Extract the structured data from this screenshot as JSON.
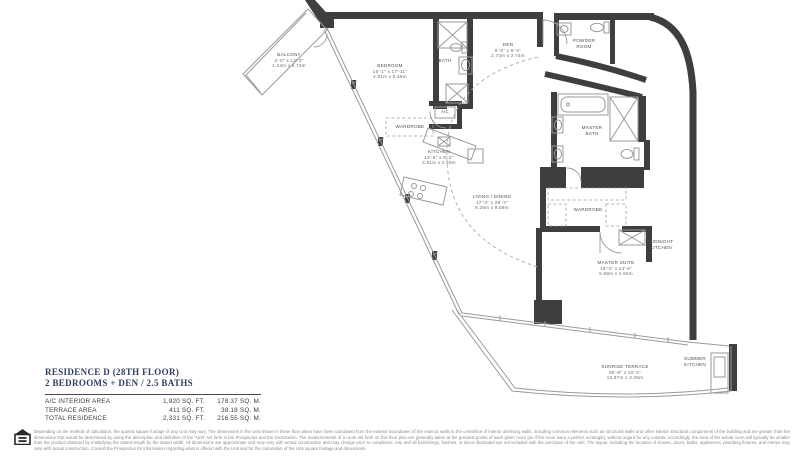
{
  "title_block": {
    "line1": "RESIDENCE D (28TH FLOOR)",
    "line2": "2 BEDROOMS + DEN / 2.5 BATHS"
  },
  "area_table": {
    "rows": [
      {
        "label": "A/C INTERIOR AREA",
        "sqft": "1,920 SQ. FT.",
        "sqm": "178.37 SQ. M."
      },
      {
        "label": "TERRACE AREA",
        "sqft": "411 SQ. FT.",
        "sqm": "38.18 SQ. M."
      },
      {
        "label": "TOTAL RESIDENCE",
        "sqft": "2,331 SQ. FT.",
        "sqm": "216.55 SQ. M."
      }
    ]
  },
  "rooms": {
    "balcony": {
      "name": "BALCONY",
      "imperial": "4'-0\" x 12'-3\"",
      "metric": "1.24m x 3.73m"
    },
    "bedroom": {
      "name": "BEDROOM",
      "imperial": "16'-1\" x 17'-11\"",
      "metric": "4.91m x 5.46m"
    },
    "bath": {
      "name": "BATH"
    },
    "den": {
      "name": "DEN",
      "imperial": "9'-0\" x 9'-0\"",
      "metric": "2.74m x 2.74m"
    },
    "powder_room": {
      "name": "POWDER ROOM"
    },
    "ac_closet": {
      "name": "A/C"
    },
    "wardrobe_bedroom": {
      "name": "WARDROBE"
    },
    "kitchen": {
      "name": "KITCHEN",
      "imperial": "12'-6\" x 8'-2\"",
      "metric": "3.81m x 2.49m"
    },
    "living_dining": {
      "name": "LIVING / DINING",
      "imperial": "17'-3\" x 28'-2\"",
      "metric": "5.26m x 8.59m"
    },
    "master_bath": {
      "name": "MASTER BATH"
    },
    "wardrobe_master": {
      "name": "WARDROBE"
    },
    "midnight_kitchen": {
      "name": "MIDNIGHT KITCHEN"
    },
    "master_suite": {
      "name": "MASTER SUITE",
      "imperial": "19'-3\" x 14'-9\"",
      "metric": "5.86m x 4.50m"
    },
    "sunrise_terrace": {
      "name": "SUNRISE TERRACE",
      "imperial": "35'-8\" x 10'-0\"",
      "metric": "10.87m x 3.05m"
    },
    "summer_kitchen": {
      "name": "SUMMER KITCHEN"
    }
  },
  "disclaimer": {
    "text": "Depending on the method of calculation, the quoted square footage of any Unit may vary.  The dimensions in the Unit shown in these floor plans have been calculated from the exterior boundaries of the exterior walls to the centerline of interior demising walls, including common elements such as structural walls and other interior structural components of the building and are greater than the dimensions that would be determined by using the description and definition of the \"Unit\" set forth in the Prospectus and the Declaration.  The measurements of a room set forth on this floor plan are generally taken at the greatest points of each given room (as if the room were a perfect rectangle), without regard for any cutouts.  Accordingly, the area of the actual room will typically be smaller than the product obtained by multiplying the stated length by the stated width.  All dimensions are approximate and may vary with actual construction and may change prior to completion.  Any and all furnishings, finishes, or decor illustrated are not included with the purchase of the Unit.  The layout, including the location of closets, doors, baths, appliances, plumbing fixtures, and entries may vary with actual construction.  Consult the Prospectus for information regarding what is offered with the Unit and for the calculation of the Unit square footage and dimensions."
  },
  "colors": {
    "wall": "#3e3e3e",
    "thin_line": "#9a9a9a",
    "label_text": "#565656",
    "title_text": "#2e3d5e"
  }
}
